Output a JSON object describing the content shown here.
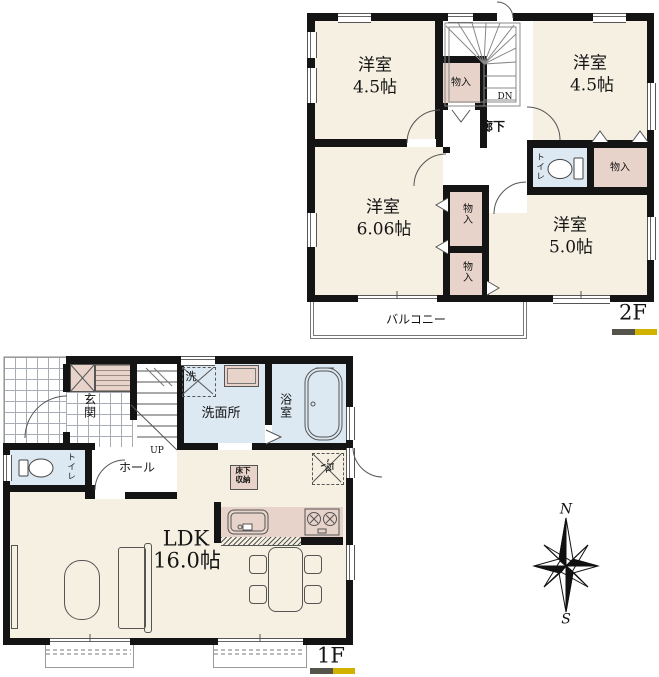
{
  "floor2f": {
    "label": "2F",
    "room_tl_name": "洋室",
    "room_tl_size": "4.5帖",
    "room_tr_name": "洋室",
    "room_tr_size": "4.5帖",
    "room_ml_name": "洋室",
    "room_ml_size": "6.06帖",
    "room_br_name": "洋室",
    "room_br_size": "5.0帖",
    "closet_stair": "物入",
    "closet_right": "物入",
    "closet_mid_upper": "物入",
    "closet_mid_lower": "物入",
    "toilet": "トイレ",
    "hallway": "廊下",
    "stairs_down": "DN",
    "balcony": "バルコニー"
  },
  "floor1f": {
    "label": "1F",
    "entrance": "玄関",
    "hall": "ホール",
    "stairs_up": "UP",
    "toilet": "トイレ",
    "washer": "洗",
    "washroom": "洗面所",
    "bathroom": "浴室",
    "underfloor_storage_line1": "床下",
    "underfloor_storage_line2": "収納",
    "refrigerator": "冷",
    "ldk_name": "LDK",
    "ldk_size": "16.0帖"
  },
  "compass": {
    "north": "N",
    "south": "S"
  },
  "colors": {
    "wall": "#141414",
    "floor": "#f6f0e2",
    "closet": "#e7d3c9",
    "water": "#dce9f3",
    "legend_dark": "#55544a",
    "legend_gold": "#d1b200"
  }
}
